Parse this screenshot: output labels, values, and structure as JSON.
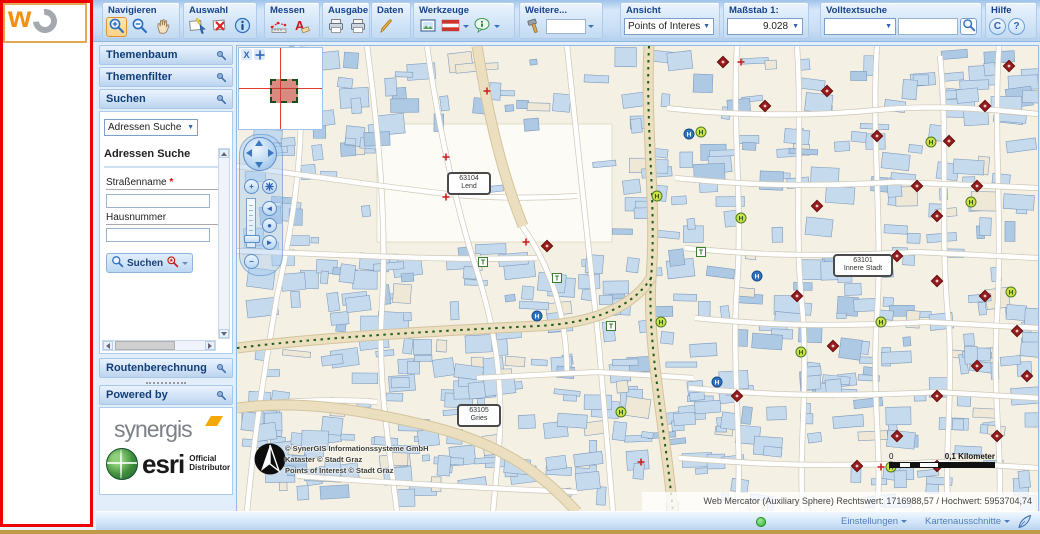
{
  "logo": {
    "w": "w",
    "o": "O"
  },
  "toolbar": {
    "navigieren": "Navigieren",
    "auswahl": "Auswahl",
    "messen": "Messen",
    "ausgabe": "Ausgabe",
    "daten": "Daten",
    "werkzeuge": "Werkzeuge",
    "weitere": "Weitere...",
    "ansicht": "Ansicht",
    "ansicht_value": "Points of Interes",
    "massstab": "Maßstab 1:",
    "massstab_value": "9.028",
    "volltextsuche": "Volltextsuche",
    "hilfe": "Hilfe",
    "hilfe_c": "C",
    "hilfe_q": "?"
  },
  "sidebar": {
    "themenbaum": "Themenbaum",
    "themenfilter": "Themenfilter",
    "suchen": "Suchen",
    "routenberechnung": "Routenberechnung",
    "powered_by": "Powered by",
    "search": {
      "type_value": "Adressen Suche",
      "title": "Adressen Suche",
      "street_label": "Straßenname",
      "required_mark": "*",
      "house_label": "Hausnummer",
      "submit": "Suchen"
    },
    "logos": {
      "synergis": "synergis",
      "esri": "esri",
      "esri_line1": "Official",
      "esri_line2": "Distributor"
    }
  },
  "map": {
    "districts": [
      {
        "code": "63104",
        "name": "Lend"
      },
      {
        "code": "63101",
        "name": "Innere Stadt"
      },
      {
        "code": "63105",
        "name": "Gries"
      }
    ],
    "copyright": [
      "© SynerGIS Informationssysteme GmbH",
      "Kataster © Stadt Graz",
      "Points of Interest © Stadt Graz"
    ],
    "scalebar": {
      "start": "0",
      "end": "0,1 Kilometer"
    },
    "status": "Web Mercator (Auxiliary Sphere) Rechtswert: 1716988,57 / Hochwert: 5953704,74"
  },
  "bottombar": {
    "einstellungen": "Einstellungen",
    "kartenausschnitte": "Kartenausschnitte"
  },
  "colors": {
    "accent_blue": "#2f62b5",
    "toolbar_text": "#15428b",
    "map_bg": "#f4f0e4",
    "building_fill": "#c6daee",
    "building_fill_dark": "#aec9e4",
    "building_fill_tan": "#efe8d6",
    "building_stroke": "#7f9cbd",
    "street_casing": "#cfc8b6",
    "tan_road": "#ecdfc0",
    "tan_casing": "#d2c49e",
    "green_line": "#1e5c1e",
    "poi_red": "#9b1c1c",
    "halt_green": "#cfe24a",
    "halt_blue": "#2f72c4",
    "selection_red": "#ee0000",
    "gold_line": "#bf9b45"
  }
}
